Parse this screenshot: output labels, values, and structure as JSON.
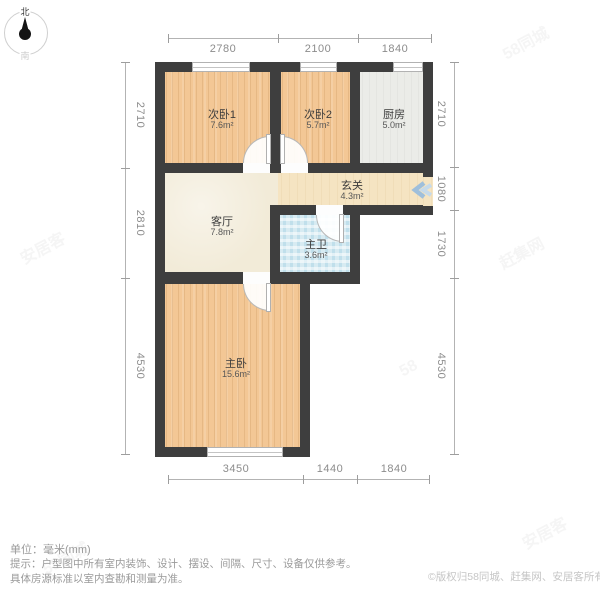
{
  "compass": {
    "north": "北",
    "south": "南"
  },
  "rooms": {
    "bedroom1": {
      "name": "次卧1",
      "area": "7.6m²"
    },
    "bedroom2": {
      "name": "次卧2",
      "area": "5.7m²"
    },
    "kitchen": {
      "name": "厨房",
      "area": "5.0m²"
    },
    "entry": {
      "name": "玄关",
      "area": "4.3m²"
    },
    "living": {
      "name": "客厅",
      "area": "7.8m²"
    },
    "bath": {
      "name": "主卫",
      "area": "3.6m²"
    },
    "master": {
      "name": "主卧",
      "area": "15.6m²"
    }
  },
  "dimensions": {
    "top": [
      "2780",
      "2100",
      "1840"
    ],
    "left": [
      "2710",
      "2810",
      "4530"
    ],
    "right": [
      "2710",
      "1080",
      "1730",
      "4530"
    ],
    "bottom": [
      "3450",
      "1440",
      "1840"
    ]
  },
  "footer": {
    "unit": "单位：毫米(mm)",
    "tip1": "提示：户型图中所有室内装饰、设计、摆设、间隔、尺寸、设备仅供参考。",
    "tip2": "具体房源标准以室内查勘和测量为准。",
    "copyright": "©版权归58同城、赶集网、安居客所有"
  },
  "watermarks": [
    "58同城",
    "安居客",
    "赶集网",
    "58同城",
    "安居客",
    "58"
  ]
}
